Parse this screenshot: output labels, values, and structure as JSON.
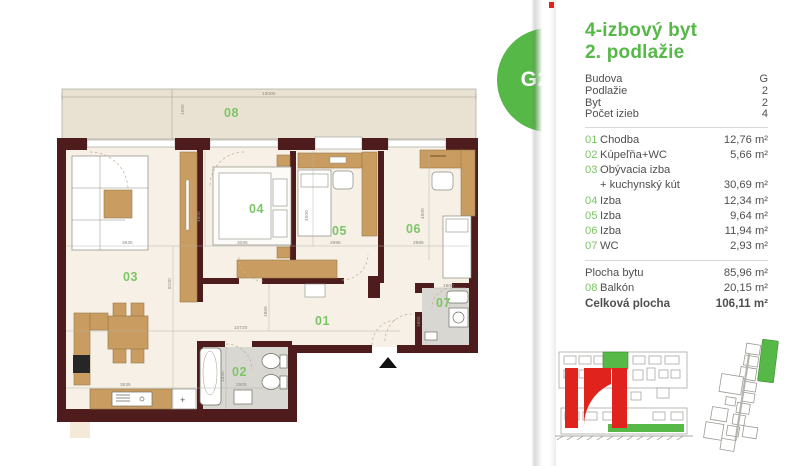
{
  "badge": {
    "label": "G2-2"
  },
  "panel": {
    "title_line1": "4-izbový byt",
    "title_line2": "2. podlažie",
    "info": [
      {
        "label": "Budova",
        "value": "G"
      },
      {
        "label": "Podlažie",
        "value": "2"
      },
      {
        "label": "Byt",
        "value": "2"
      },
      {
        "label": "Počet izieb",
        "value": "4"
      }
    ],
    "rooms": [
      {
        "num": "01",
        "label": "Chodba",
        "value": "12,76 m²"
      },
      {
        "num": "02",
        "label": "Kúpeľňa+WC",
        "value": "5,66 m²"
      },
      {
        "num": "03",
        "label": "Obývacia izba",
        "value": ""
      },
      {
        "num": "",
        "label": "+ kuchynský kút",
        "value": "30,69 m²"
      },
      {
        "num": "04",
        "label": "Izba",
        "value": "12,34 m²"
      },
      {
        "num": "05",
        "label": "Izba",
        "value": "9,64 m²"
      },
      {
        "num": "06",
        "label": "Izba",
        "value": "11,94 m²"
      },
      {
        "num": "07",
        "label": "WC",
        "value": "2,93 m²"
      }
    ],
    "summary": [
      {
        "num": "",
        "label": "Plocha bytu",
        "value": "85,96 m²"
      },
      {
        "num": "08",
        "label": "Balkón",
        "value": "20,15 m²"
      },
      {
        "num": "",
        "label": "Celková plocha",
        "value": "106,11 m²"
      }
    ]
  },
  "plan": {
    "rooms": {
      "r1": "01",
      "r2": "02",
      "r3": "03",
      "r4": "04",
      "r5": "05",
      "r6": "06",
      "r7": "07",
      "r8": "08"
    },
    "dims": {
      "top": "13000",
      "depth": "1950",
      "sofa": "3835",
      "h03": "8100",
      "kitchen": "3835",
      "v04": "4600",
      "w04": "3085",
      "v05": "4500",
      "w05": "2985",
      "v06": "4500",
      "w06": "2985",
      "hall": "10720",
      "hallv": "1865",
      "bathw": "2905",
      "bathv": "1835",
      "wcw": "1800",
      "wcv": "1865"
    }
  },
  "colors": {
    "accent_green": "#56b847",
    "label_green": "#7cc565",
    "wall": "#4e1c1c",
    "balcony": "#e9e1d2",
    "floor": "#f6f0e7",
    "wet_floor": "#d9d7d2",
    "furniture_tan": "#c99d61",
    "logo_red": "#e0231c",
    "text_dark": "#4f4f4f",
    "dim_gray": "#8d8d85"
  }
}
